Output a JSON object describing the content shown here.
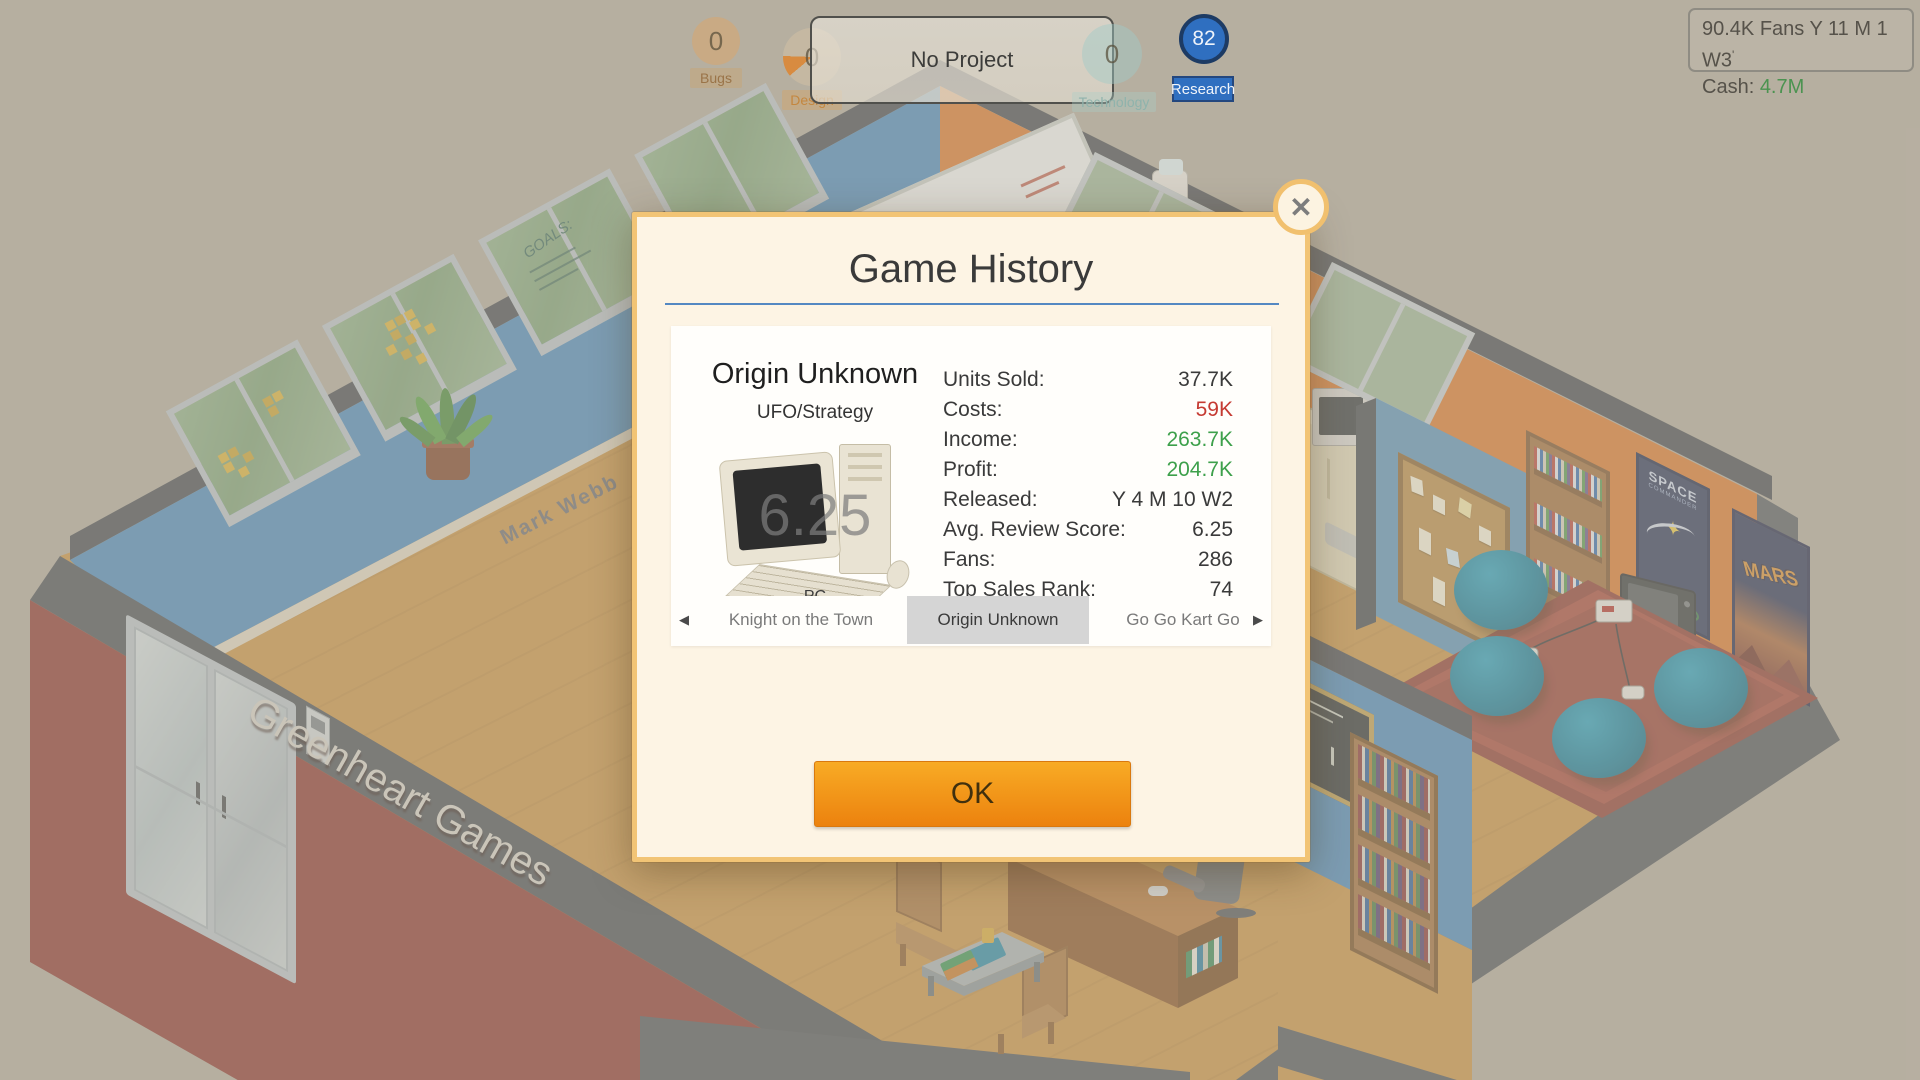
{
  "hud": {
    "bugs": {
      "value": "0",
      "label": "Bugs"
    },
    "design": {
      "value": "0",
      "label": "Design"
    },
    "technology": {
      "value": "0",
      "label": "Technology"
    },
    "research": {
      "value": "82",
      "label": "Research"
    },
    "project_bar": {
      "label": "No Project"
    },
    "status_box": {
      "fans": "90.4K Fans",
      "date": "Y 11 M 1 W3",
      "tick": "'",
      "cash_label": "Cash:",
      "cash_value": "4.7M"
    }
  },
  "dialog": {
    "title": "Game History",
    "close_glyph": "✕",
    "game": {
      "name": "Origin Unknown",
      "genre": "UFO/Strategy",
      "score_watermark": "6.25",
      "platform": "PC",
      "rating": "Mature",
      "stats": [
        {
          "label": "Units Sold:",
          "value": "37.7K",
          "color": "default"
        },
        {
          "label": "Costs:",
          "value": "59K",
          "color": "red"
        },
        {
          "label": "Income:",
          "value": "263.7K",
          "color": "green"
        },
        {
          "label": "Profit:",
          "value": "204.7K",
          "color": "green"
        },
        {
          "label": "Released:",
          "value": "Y 4 M 10 W2",
          "color": "default"
        },
        {
          "label": "Avg. Review Score:",
          "value": "6.25",
          "color": "default"
        },
        {
          "label": "Fans:",
          "value": "286",
          "color": "default"
        },
        {
          "label": "Top Sales Rank:",
          "value": "74",
          "color": "default"
        }
      ]
    },
    "nav": {
      "left_arrow": "◀",
      "right_arrow": "▶",
      "prev_game": "Knight on the Town",
      "current_game": "Origin Unknown",
      "next_game": "Go Go Kart Go"
    },
    "ok_label": "OK"
  },
  "scene": {
    "company_sign": "Greenheart Games",
    "floor_name": "Mark Webb",
    "window_scribble": "GOALS:",
    "posters": {
      "space_title": "SPACE",
      "space_subtitle": "COMMANDER",
      "mars_title": "MARS"
    }
  },
  "colors": {
    "dialog_border": "#f2c475",
    "dialog_bg": "#fdf4e4",
    "ok_gradient_top": "#f8ab25",
    "ok_gradient_bottom": "#ec820e",
    "underline_blue": "#5488c2",
    "stat_red": "#c53a32",
    "stat_green": "#3da04b",
    "cash_green": "#4b9350",
    "research_blue": "#2f6fc0",
    "wall_blue": "#4f8bbc",
    "wall_orange": "#d97a33",
    "wall_maroon": "#8e3c34",
    "floor_wood": "#c89348",
    "beanbag_teal": "#1b7f9c",
    "outer_ground": "#b2ab9e"
  }
}
